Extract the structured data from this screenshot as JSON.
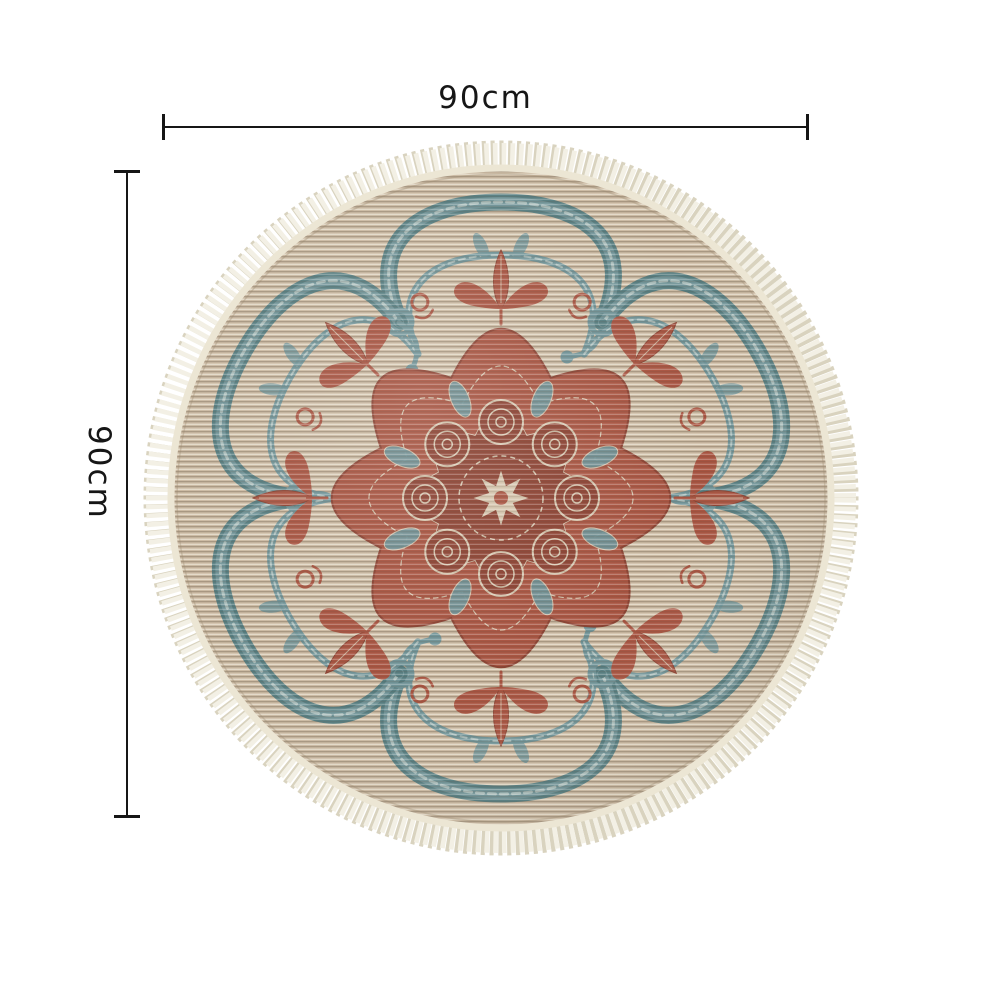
{
  "figure": {
    "description": "Round woven mandala area rug with cream tassel fringe, teal acanthus scroll border and rust-red floral medallion center"
  },
  "annotations": {
    "width": {
      "label": "90cm"
    },
    "height": {
      "label": "90cm"
    }
  },
  "colors": {
    "background": "#ffffff",
    "annotation-ink": "#161616",
    "rug-base": "#cbbaa3",
    "weave-light": "#dbceb8",
    "weave-dark": "#b2a089",
    "teal": "#6f9296",
    "teal-dark": "#567d80",
    "teal-light": "#a9bdbb",
    "red": "#a85441",
    "red-dark": "#8c4232",
    "accent-beige": "#d5c5ae",
    "fringe": "#f3f0e5",
    "fringe-shadow": "#d9d3bf",
    "binding": "#ece6d4"
  }
}
